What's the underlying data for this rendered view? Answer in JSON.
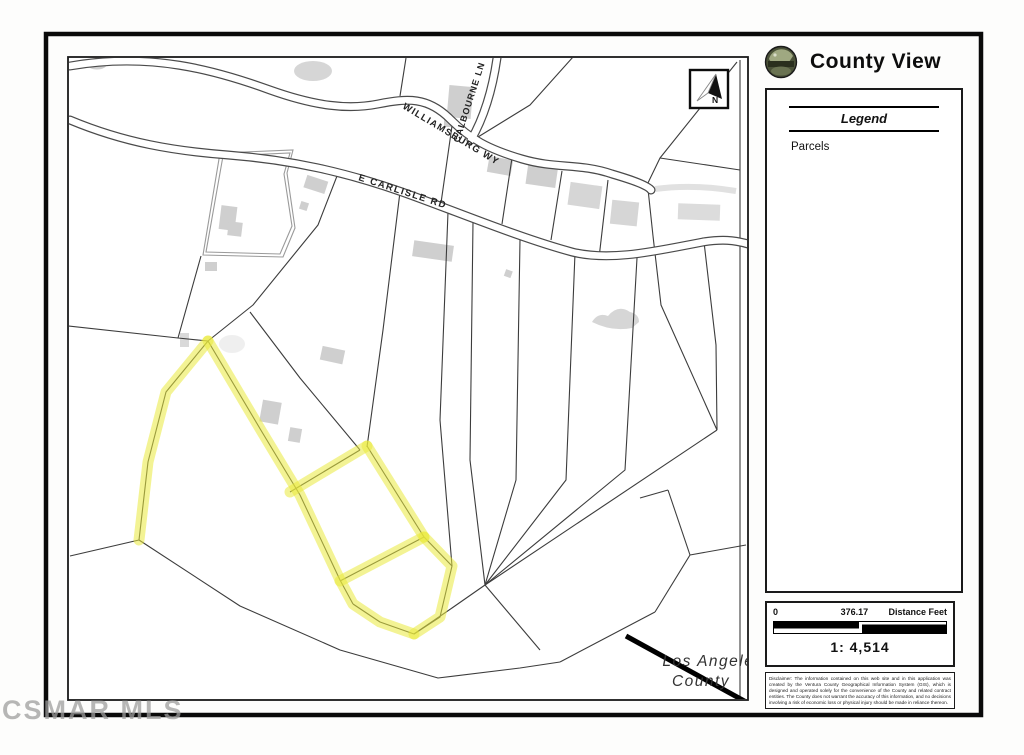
{
  "watermark": "CSMAR MLS",
  "header": {
    "title": "County View"
  },
  "north": {
    "label": "N"
  },
  "legend": {
    "title": "Legend",
    "items": [
      {
        "label": "Parcels"
      }
    ]
  },
  "map": {
    "roads": [
      {
        "label": "WILLIAMSBURG WY"
      },
      {
        "label": "CALBOURNE LN"
      },
      {
        "label": "E CARLISLE RD"
      }
    ],
    "jurisdiction_label": {
      "line1": "Los Angeles",
      "line2": "County"
    }
  },
  "scale": {
    "zero": "0",
    "midpoint": "376.17",
    "units": "Distance Feet",
    "ratio": "1: 4,514"
  },
  "disclaimer": "Disclaimer: The information contained on this web site and in this application was created by the Ventura County Geographical Information System (GIS), which is designed and operated solely for the convenience of the County and related contract entities. The County does not warrant the accuracy of this information, and no decisions involving a risk of economic loss or physical injury should be made in reliance thereon.",
  "colors": {
    "parcel_highlight": "#e9e93c",
    "road_line": "#4a4a4a",
    "parcel_line": "#3c3c3c",
    "building_fill": "#c7c7c7",
    "county_boundary": "#000000"
  }
}
